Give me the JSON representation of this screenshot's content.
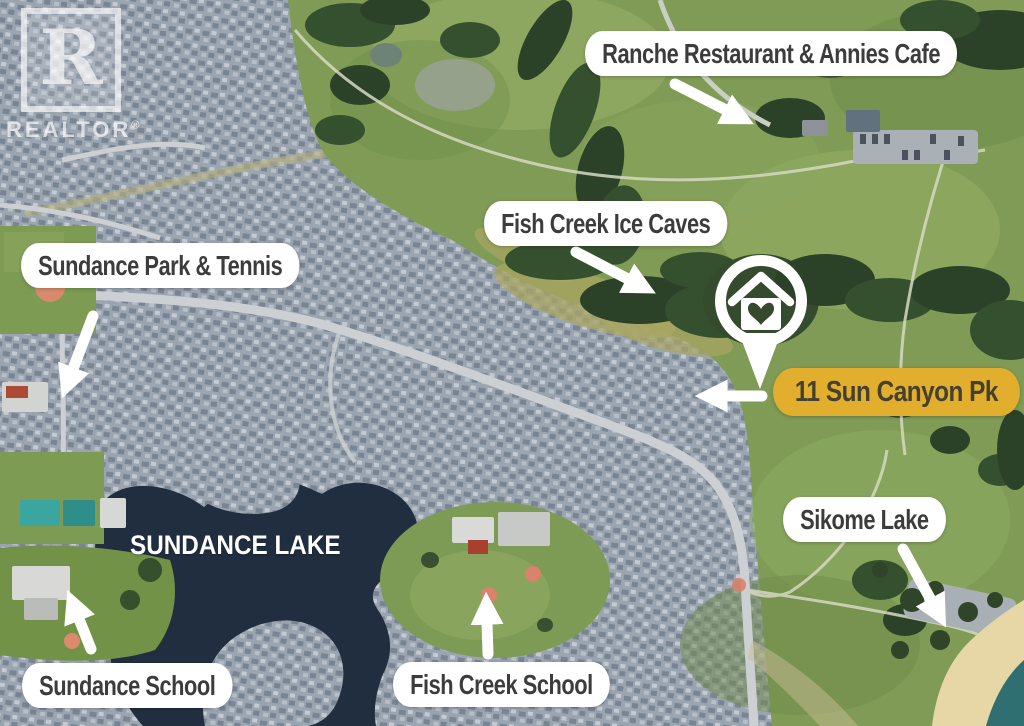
{
  "realtor_watermark": {
    "logo_letter": "R",
    "wordmark": "REALTOR",
    "registered_mark": "®"
  },
  "labels": {
    "ranche": "Ranche Restaurant & Annies Cafe",
    "ice_caves": "Fish Creek Ice Caves",
    "sundance_park": "Sundance Park & Tennis",
    "subject_address": "11 Sun Canyon Pk",
    "sikome": "Sikome Lake",
    "sundance_school": "Sundance School",
    "fish_creek_school": "Fish Creek School",
    "lake": "SUNDANCE LAKE"
  },
  "marker": {
    "type": "subject-property-pin",
    "icon": "house-with-heart-icon"
  },
  "colors": {
    "pill_bg": "#FFFFFF",
    "pill_text": "#3C3C3C",
    "gold_bg": "#E2AE2E",
    "gold_text": "#45402F",
    "lake_water": "#202E40",
    "arrow": "#FFFFFF"
  }
}
